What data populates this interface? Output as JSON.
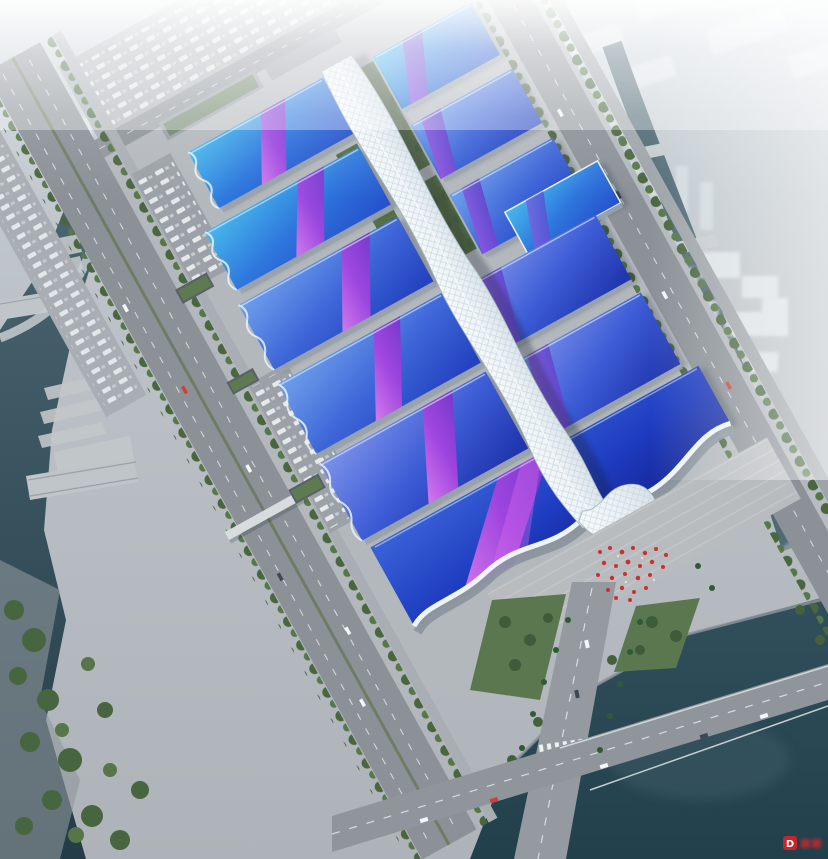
{
  "scene": {
    "type": "architectural-aerial-rendering",
    "subject": "Aerial rendering of a large exhibition and convention center with a central white spine corridor, blue and purple gradient hall roofs, tree-lined boulevards and rivers",
    "watermark": {
      "logo_text": "D"
    },
    "palette": {
      "roof_cyan": "#48b8ec",
      "roof_blue": "#2e77dd",
      "roof_deep_blue": "#2136ae",
      "swoosh_magenta": "#e27cf0",
      "swoosh_purple": "#7c33cc",
      "spine_white": "#f6fafc",
      "water_dark": "#2a434e",
      "road_gray": "#8b9197",
      "tree_green": "#49663f",
      "fog_white": "#ffffff",
      "accent_red": "#cd2f2f"
    },
    "landmarks": {
      "central_spine": "central-spine-corridor",
      "exhibition_halls": "exhibition-halls-with-gradient-roofs",
      "entrance_hall": "south-entrance-hall-wave-canopy",
      "west_river": "west-river",
      "southeast_river": "southeast-river",
      "boulevard": "tree-lined-boulevard"
    }
  }
}
